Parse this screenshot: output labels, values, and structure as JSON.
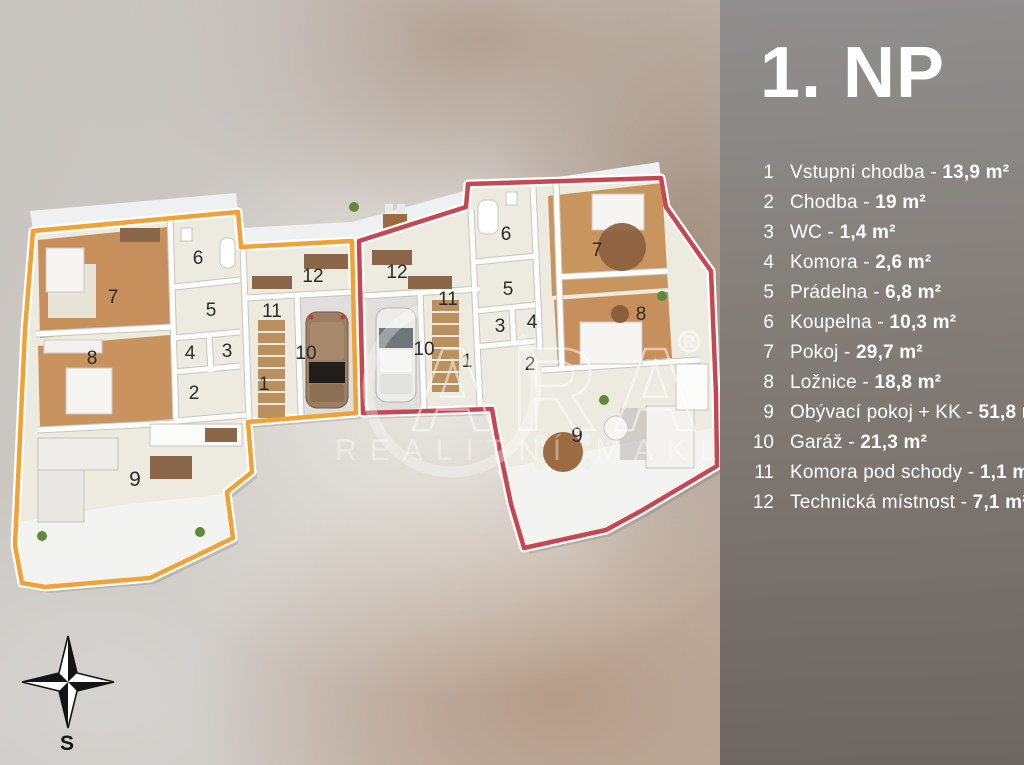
{
  "sidebar": {
    "title": "1. NP",
    "separator": " - ",
    "legend": [
      {
        "num": "1",
        "name": "Vstupní chodba",
        "area": "13,9 m²"
      },
      {
        "num": "2",
        "name": "Chodba",
        "area": "19 m²"
      },
      {
        "num": "3",
        "name": "WC",
        "area": "1,4 m²"
      },
      {
        "num": "4",
        "name": "Komora",
        "area": "2,6 m²"
      },
      {
        "num": "5",
        "name": "Prádelna",
        "area": "6,8 m²"
      },
      {
        "num": "6",
        "name": "Koupelna",
        "area": "10,3 m²"
      },
      {
        "num": "7",
        "name": "Pokoj",
        "area": "29,7 m²"
      },
      {
        "num": "8",
        "name": "Ložnice",
        "area": "18,8 m²"
      },
      {
        "num": "9",
        "name": "Obývací pokoj + KK",
        "area": "51,8 m²"
      },
      {
        "num": "10",
        "name": "Garáž",
        "area": "21,3 m²"
      },
      {
        "num": "11",
        "name": "Komora pod schody",
        "area": "1,1 m²"
      },
      {
        "num": "12",
        "name": "Technická místnost",
        "area": "7,1 m²"
      }
    ]
  },
  "plan": {
    "outline_colors": {
      "left_unit": "#f0a236",
      "right_unit": "#c64751"
    },
    "labels": [
      {
        "n": "7"
      },
      {
        "n": "6"
      },
      {
        "n": "12"
      },
      {
        "n": "5"
      },
      {
        "n": "11"
      },
      {
        "n": "4"
      },
      {
        "n": "3"
      },
      {
        "n": "10"
      },
      {
        "n": "8"
      },
      {
        "n": "2"
      },
      {
        "n": "1"
      },
      {
        "n": "9"
      },
      {
        "n": "6"
      },
      {
        "n": "7"
      },
      {
        "n": "12"
      },
      {
        "n": "11"
      },
      {
        "n": "5"
      },
      {
        "n": "3"
      },
      {
        "n": "4"
      },
      {
        "n": "10"
      },
      {
        "n": "1"
      },
      {
        "n": "2"
      },
      {
        "n": "8"
      },
      {
        "n": "9"
      }
    ]
  },
  "watermark": {
    "brand": "ARA",
    "registered": "®",
    "subtitle": "REALITNÍ MAKLÉŘ"
  },
  "compass": {
    "label": "S"
  }
}
